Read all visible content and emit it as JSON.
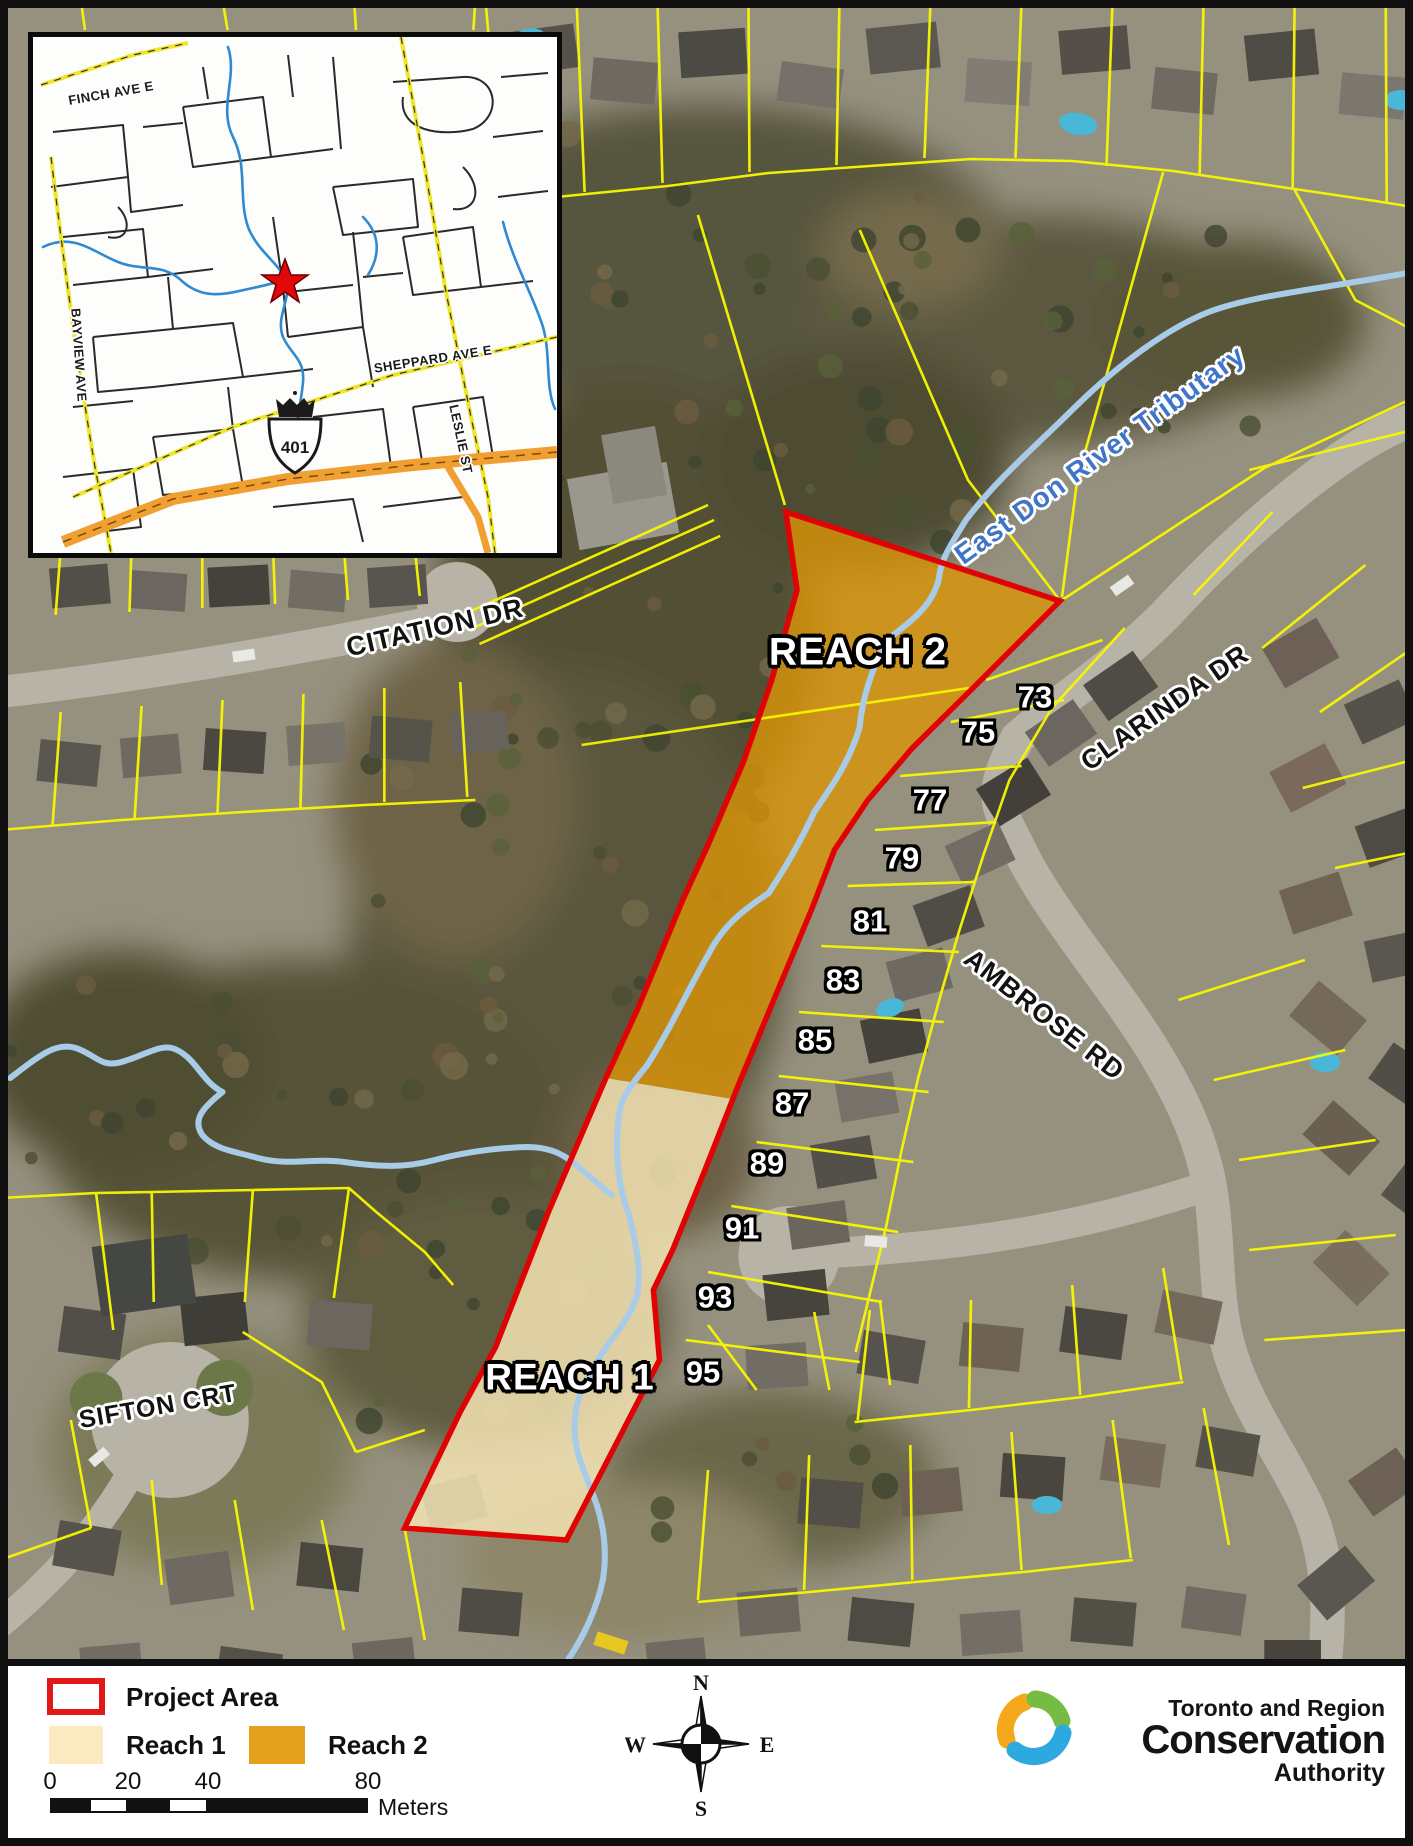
{
  "map": {
    "reach_labels": {
      "reach1": "REACH 1",
      "reach2": "REACH 2"
    },
    "river_label": "East Don River Tributary",
    "streets": {
      "citation": "CITATION DR",
      "clarinda": "CLARINDA DR",
      "ambrose": "AMBROSE RD",
      "sifton": "SIFTON CRT"
    },
    "house_numbers": [
      "73",
      "75",
      "77",
      "79",
      "81",
      "83",
      "85",
      "87",
      "89",
      "91",
      "93",
      "95"
    ]
  },
  "inset": {
    "streets": {
      "finch": "FINCH AVE E",
      "sheppard": "SHEPPARD AVE E",
      "bayview": "BAYVIEW AVE",
      "leslie": "LESLIE ST"
    },
    "highway_shield": "401"
  },
  "legend": {
    "project_area_label": "Project Area",
    "reach1_label": "Reach 1",
    "reach2_label": "Reach 2",
    "scale": {
      "ticks": [
        "0",
        "20",
        "40",
        "80"
      ],
      "unit": "Meters"
    },
    "compass": {
      "n": "N",
      "s": "S",
      "e": "E",
      "w": "W"
    },
    "logo": {
      "line1": "Toronto and Region",
      "line2": "Conservation",
      "line3": "Authority"
    }
  },
  "colors": {
    "project_area_red": "#e00303",
    "reach1_fill": "#f5e4b4",
    "reach2_fill": "#d89408",
    "parcel_yellow": "#f8f800",
    "river_blue": "#a8cbe8",
    "inset_stream_blue": "#2f8ad2",
    "highway_orange": "#f0a030",
    "river_label_blue": "#3f74c8"
  }
}
